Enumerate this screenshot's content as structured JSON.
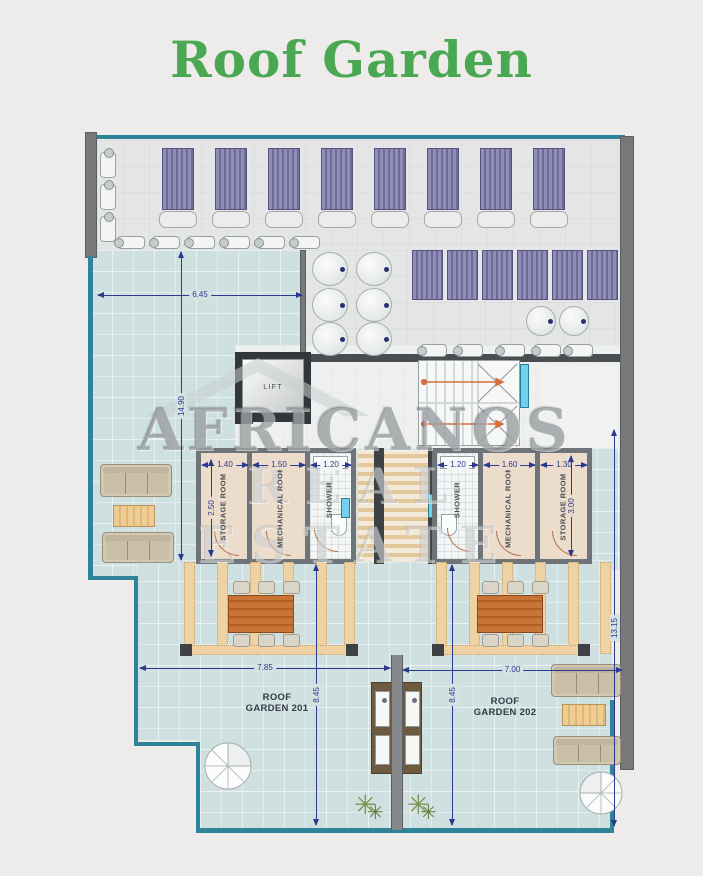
{
  "title": "Roof Garden",
  "watermark": {
    "brand": "AFRICANOS",
    "tagline": "REAL ESTATE"
  },
  "plan": {
    "lift_label": "LIFT",
    "dimensions": {
      "terrace_width": "6.45",
      "left_total_height": "14.90",
      "right_total_height": "13.15",
      "storage_201_depth": "2.50",
      "storage_202_depth": "3.00",
      "garden_201_width": "7.85",
      "garden_202_width": "7.00",
      "garden_201_depth": "8.45",
      "garden_202_depth": "8.45"
    },
    "unit_201": {
      "name_line1": "ROOF",
      "name_line2": "GARDEN 201",
      "rooms": [
        {
          "name": "STORAGE ROOM",
          "width": "1.40"
        },
        {
          "name": "MECHANICAL ROOM",
          "width": "1.50"
        },
        {
          "name": "SHOWER",
          "width": "1.20"
        }
      ]
    },
    "unit_202": {
      "name_line1": "ROOF",
      "name_line2": "GARDEN 202",
      "rooms": [
        {
          "name": "SHOWER",
          "width": "1.20"
        },
        {
          "name": "MECHANICAL ROOM",
          "width": "1.60"
        },
        {
          "name": "STORAGE ROOM",
          "width": "1.30"
        }
      ]
    }
  },
  "colors": {
    "title_green": "#4aa752",
    "dimension_navy": "#2b3a8e",
    "railing_teal": "#2e8399",
    "deck_tile": "#cfe0e0",
    "lounger_purple": "#8d8ab2",
    "pergola_wood": "#eed2a4",
    "dining_table_wood": "#c4703a",
    "room_beige": "#ecdccb",
    "wall_gray": "#75797c"
  }
}
